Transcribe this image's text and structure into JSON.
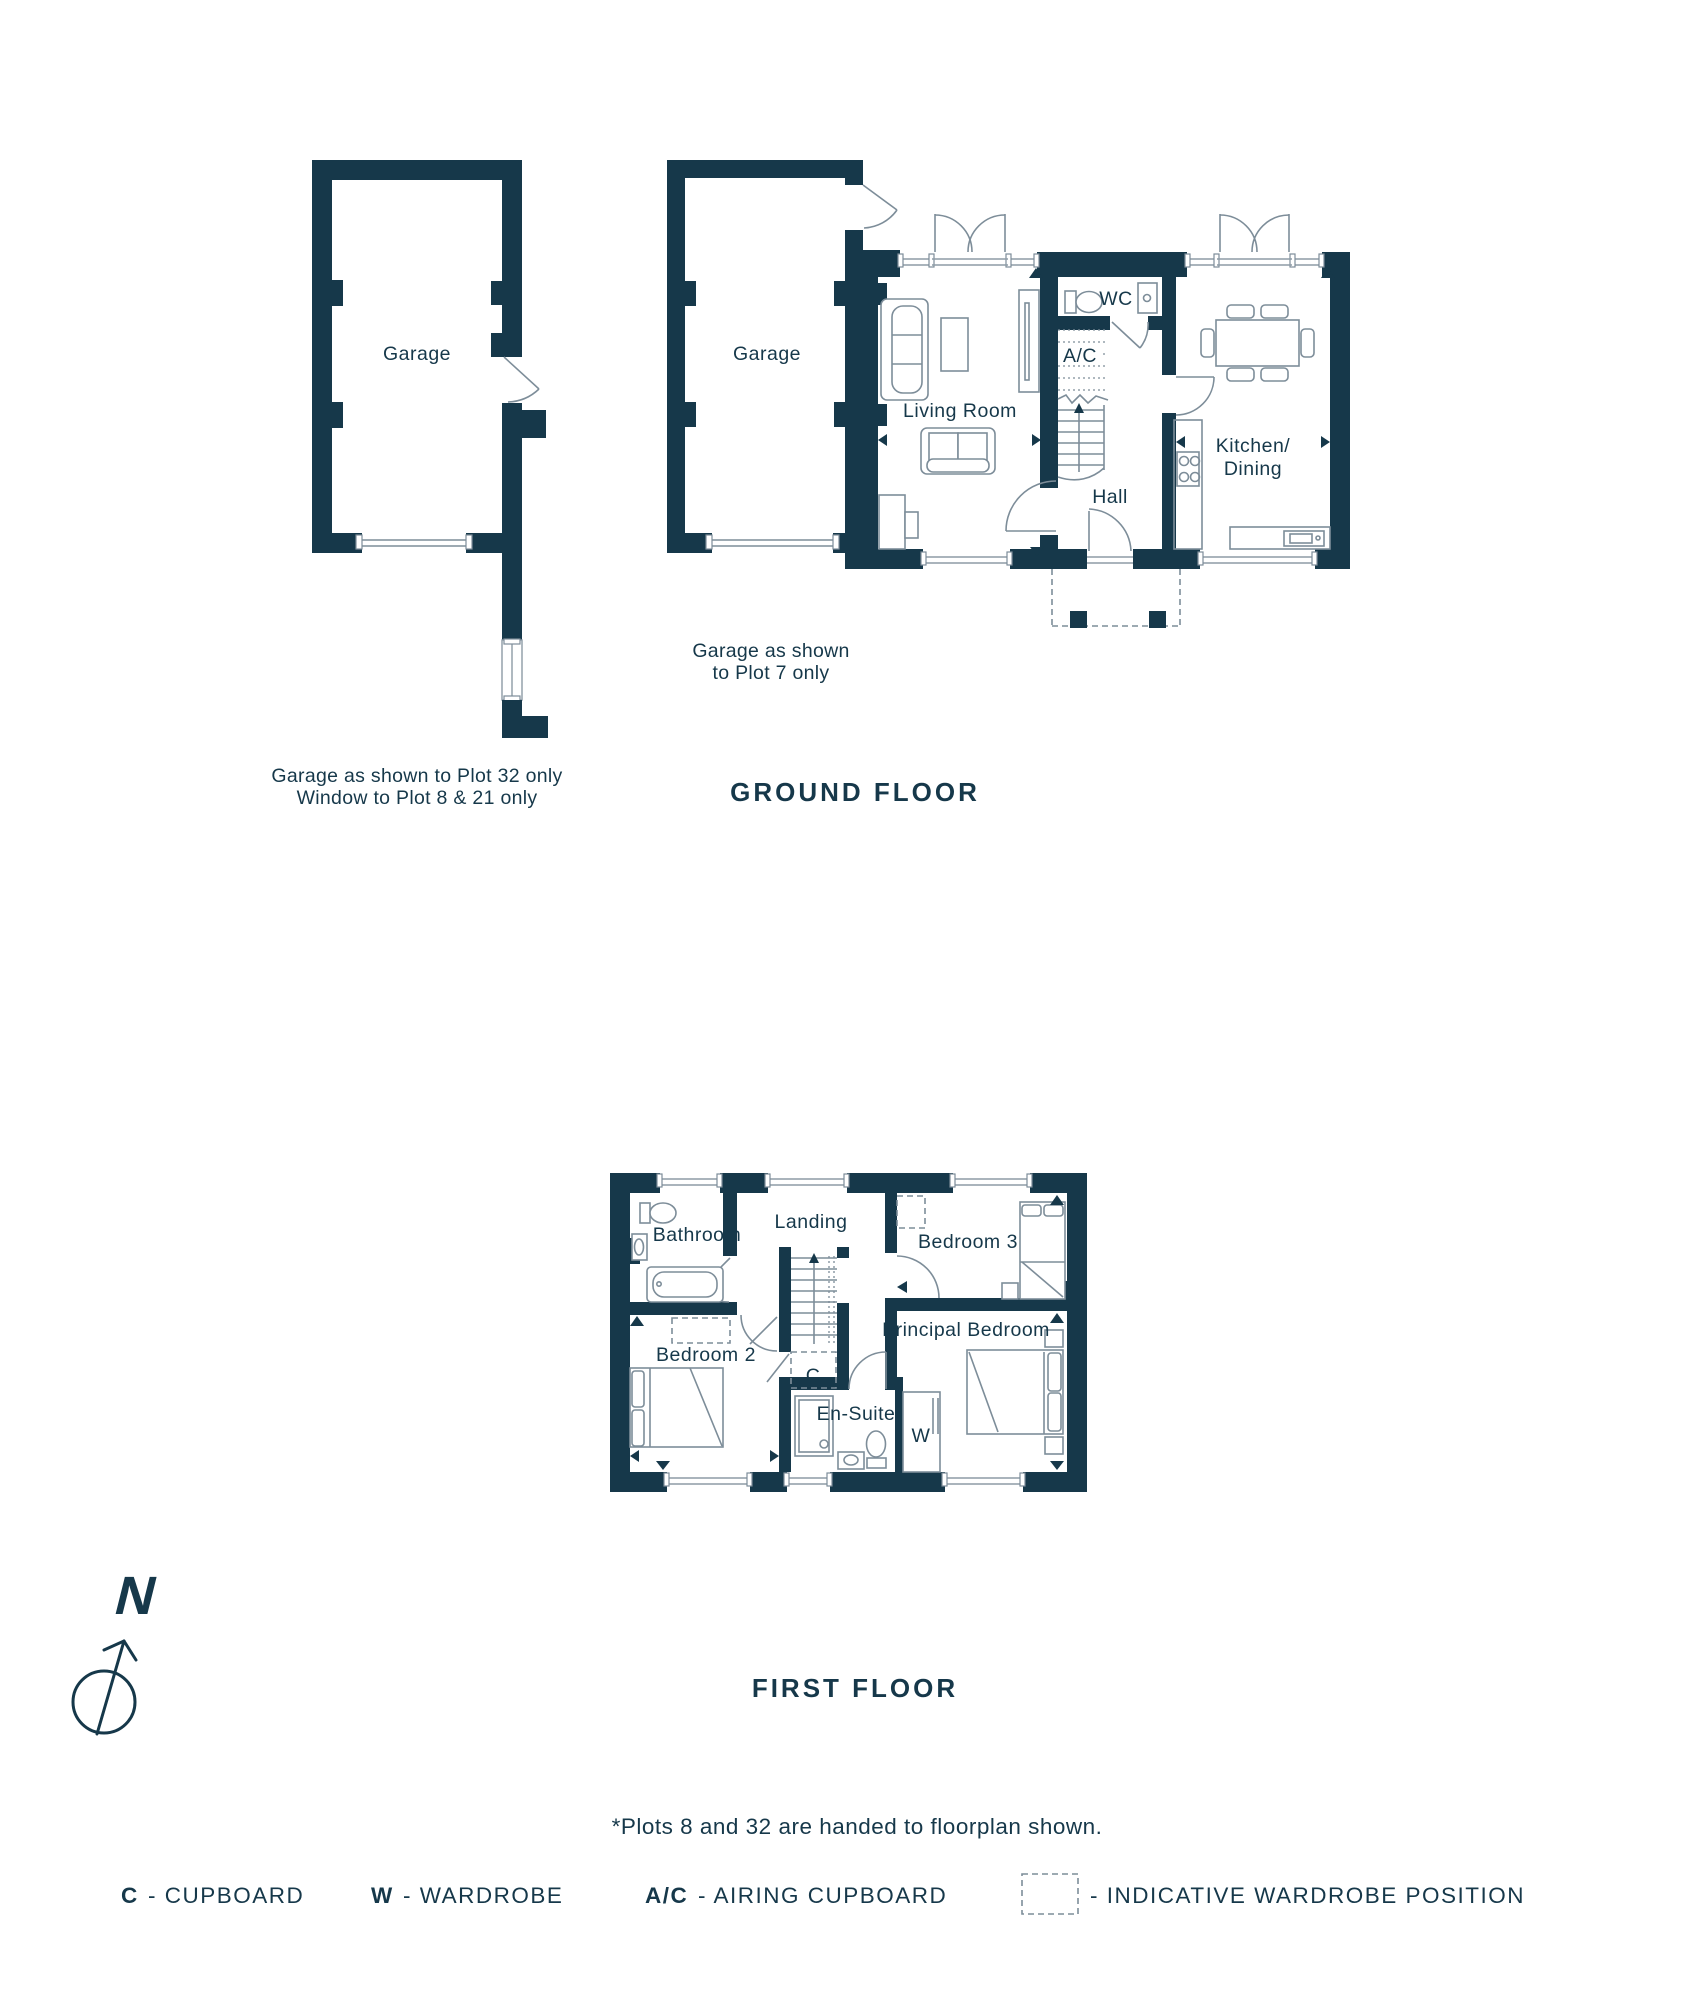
{
  "colors": {
    "wall": "#16384a",
    "line": "#7d8d99",
    "text": "#16384a",
    "background": "#ffffff"
  },
  "ground_floor": {
    "heading": "GROUND FLOOR",
    "rooms": {
      "garage_detached": "Garage",
      "garage_attached": "Garage",
      "living_room": "Living Room",
      "wc": "WC",
      "airing_cupboard": "A/C",
      "hall": "Hall",
      "kitchen_dining": [
        "Kitchen/",
        "Dining"
      ]
    },
    "notes": {
      "detached_garage": [
        "Garage as shown to Plot 32 only",
        "Window to Plot 8 & 21 only"
      ],
      "attached_garage": [
        "Garage as shown",
        "to Plot 7 only"
      ]
    }
  },
  "first_floor": {
    "heading": "FIRST FLOOR",
    "rooms": {
      "bathroom": "Bathroom",
      "landing": "Landing",
      "bedroom_3": "Bedroom 3",
      "bedroom_2": "Bedroom 2",
      "principal_bedroom": "Principal Bedroom",
      "en_suite": "En-Suite",
      "cupboard": "C",
      "wardrobe": "W"
    }
  },
  "compass": {
    "north": "N"
  },
  "footnote": "*Plots 8 and 32 are handed to floorplan shown.",
  "legend": {
    "cupboard_key": "C",
    "cupboard_label": "- CUPBOARD",
    "wardrobe_key": "W",
    "wardrobe_label": "- WARDROBE",
    "airing_key": "A/C",
    "airing_label": "- AIRING CUPBOARD",
    "indicative_label": "- INDICATIVE WARDROBE POSITION"
  }
}
